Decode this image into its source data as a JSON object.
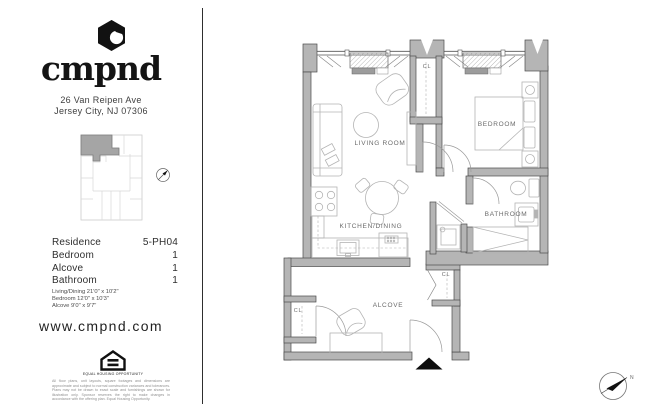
{
  "brand": {
    "wordmark": "cmpnd",
    "address_line1": "26 Van Reipen Ave",
    "address_line2": "Jersey City, NJ 07306",
    "website": "www.cmpnd.com"
  },
  "unit_info": {
    "rows": [
      {
        "label": "Residence",
        "value": "5-PH04"
      },
      {
        "label": "Bedroom",
        "value": "1"
      },
      {
        "label": "Alcove",
        "value": "1"
      },
      {
        "label": "Bathroom",
        "value": "1"
      }
    ],
    "dimensions": [
      "Living/Dining 21'0\" x 10'2\"",
      "Bedroom 12'0\" x 10'3\"",
      "Alcove 9'0\" x 9'7\""
    ]
  },
  "floor_plan": {
    "labels": {
      "living_room": "LIVING ROOM",
      "bedroom": "BEDROOM",
      "kitchen_dining": "KITCHEN/DINING",
      "bathroom": "BATHROOM",
      "alcove": "ALCOVE",
      "closet_center": "CL",
      "closet_left": "CL",
      "closet_right": "CL"
    },
    "north_label": "N"
  },
  "legal": {
    "equal_housing_label": "EQUAL HOUSING OPPORTUNITY",
    "disclaimer": "All floor plans, unit layouts, square footages and dimensions are approximate and subject to normal construction variances and tolerances. Plans may not be drawn to exact scale and furnishings are shown for illustration only. Sponsor reserves the right to make changes in accordance with the offering plan. Equal Housing Opportunity."
  },
  "colors": {
    "wall_fill": "#b5b5b5",
    "wall_stroke": "#4a4a4a",
    "furniture_stroke": "#b4b4b4",
    "label_gray": "#6a6a6a",
    "black": "#111111"
  }
}
